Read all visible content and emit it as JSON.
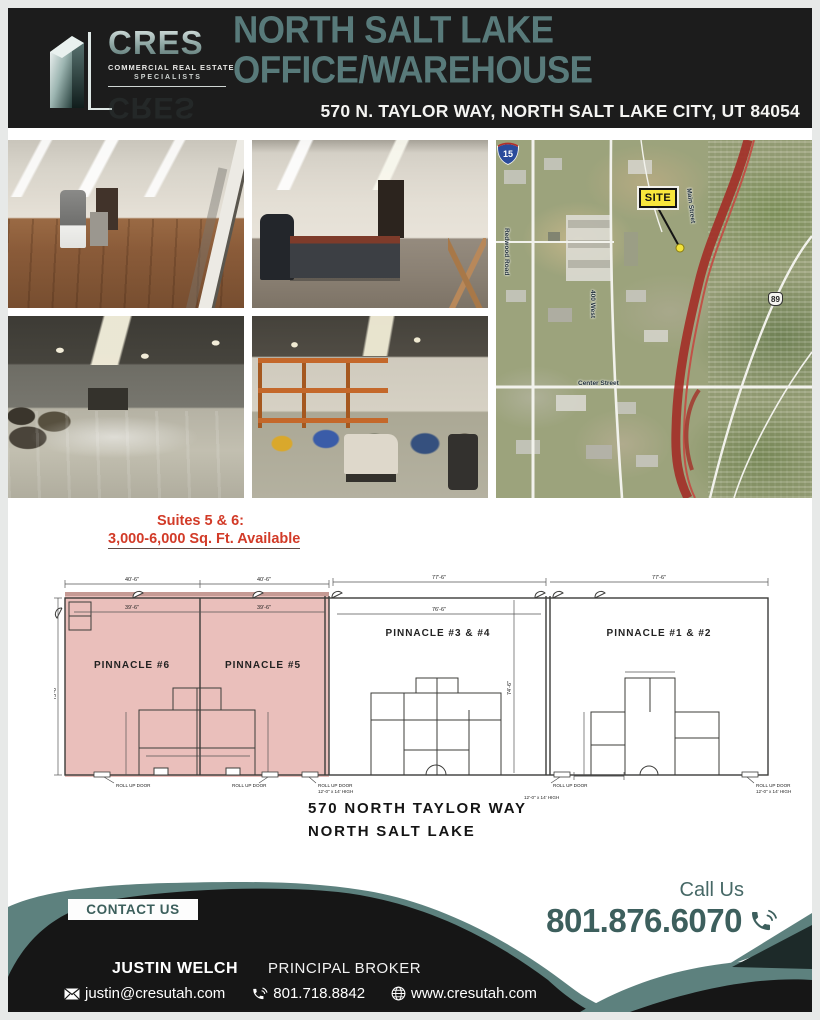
{
  "header": {
    "logo": {
      "acronym": "CRES",
      "tagline1": "COMMERCIAL REAL ESTATE",
      "tagline2": "SPECIALISTS"
    },
    "title": "NORTH SALT LAKE OFFICE/WAREHOUSE",
    "address": "570 N. TAYLOR WAY, NORTH SALT LAKE CITY, UT 84054"
  },
  "photos": {
    "photo1": "office room with equipment and wood floor",
    "photo2": "office room with desk",
    "photo3": "open warehouse bay",
    "photo4": "warehouse with pallet racking"
  },
  "map": {
    "site_label": "SITE",
    "interstate_15": "15",
    "route_89": "89",
    "streets": {
      "redwood": "Redwood Road",
      "west400": "400 West",
      "main": "Main Street",
      "center": "Center Street"
    }
  },
  "availability": {
    "line1": "Suites 5 & 6:",
    "line2": "3,000-6,000 Sq. Ft. Available"
  },
  "floorplan": {
    "unit6": "PINNACLE #6",
    "unit5": "PINNACLE #5",
    "unit34": "PINNACLE #3 & #4",
    "unit12": "PINNACLE #1 & #2",
    "dim_top_1": "40'-6\"",
    "dim_top_2": "40'-6\"",
    "dim_top_3": "77'-6\"",
    "dim_top_4": "77'-6\"",
    "dim_inner_1": "39'-6\"",
    "dim_inner_2": "39'-6\"",
    "dim_inner_3": "76'-6\"",
    "dim_side_left": "75'-0\"",
    "dim_side_mid": "74'-6\"",
    "rollup": "ROLL UP DOOR",
    "rollup_size": "12'-0\" x 14' HIGH",
    "caption1": "570 NORTH TAYLOR WAY",
    "caption2": "NORTH SALT LAKE"
  },
  "footer": {
    "contact_us": "CONTACT US",
    "call_us": "Call Us",
    "phone_main": "801.876.6070",
    "agent": "JUSTIN WELCH",
    "role": "PRINCIPAL BROKER",
    "email": "justin@cresutah.com",
    "phone": "801.718.8842",
    "website": "www.cresutah.com"
  },
  "colors": {
    "accent_teal": "#587a7a",
    "wave_teal": "#5d817e",
    "dark_teal": "#3d5f5d",
    "red": "#d23b28",
    "header_bg": "#1c1c1c",
    "black": "#161616"
  }
}
